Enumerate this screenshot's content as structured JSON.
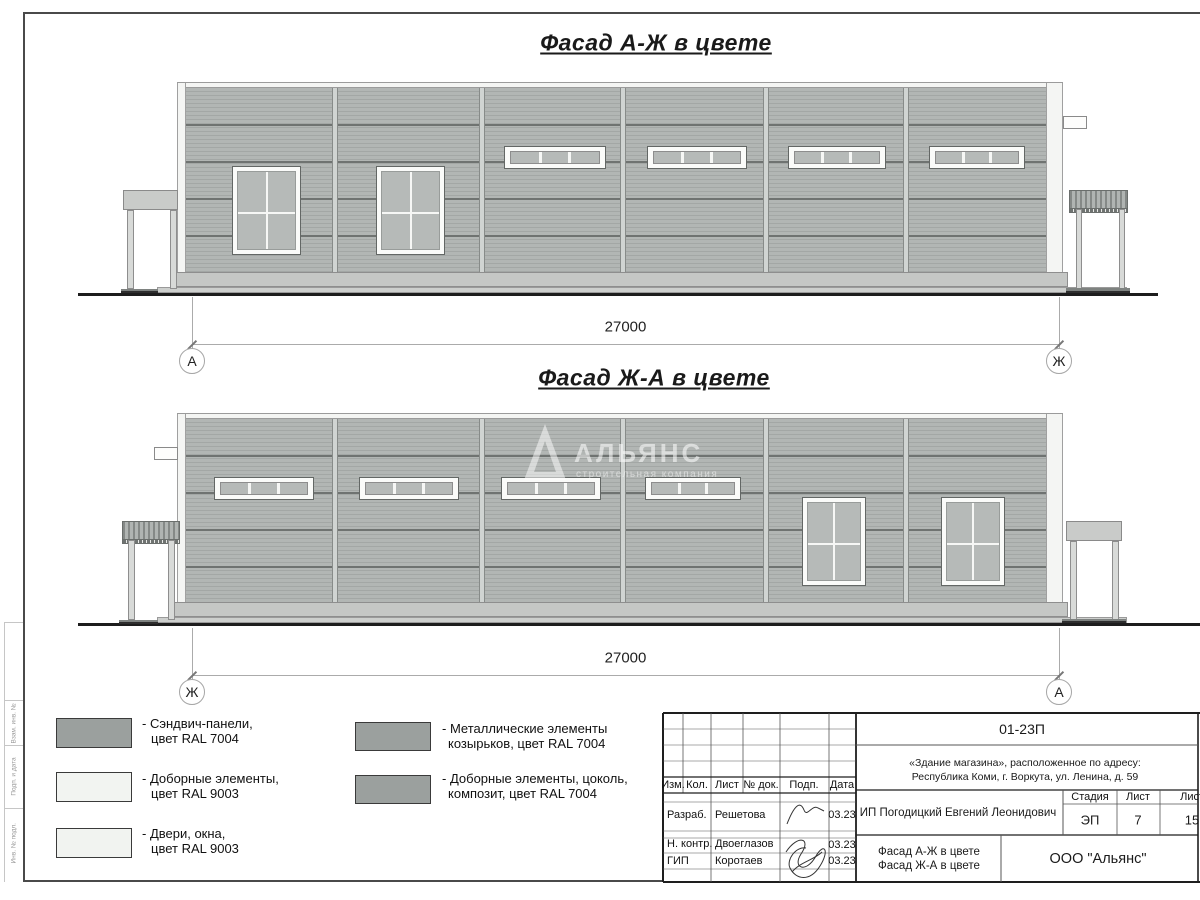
{
  "facades": [
    {
      "title": "Фасад А-Ж в цвете",
      "dim": "27000",
      "axis_left": "А",
      "axis_right": "Ж"
    },
    {
      "title": "Фасад Ж-А в цвете",
      "dim": "27000",
      "axis_left": "Ж",
      "axis_right": "А"
    }
  ],
  "watermark": {
    "name": "АЛЬЯНС",
    "tagline": "строительная компания"
  },
  "legend": {
    "items": [
      {
        "color": "#9ba09e",
        "line1": "- Сэндвич-панели,",
        "line2": "цвет RAL 7004"
      },
      {
        "color": "#f2f4f1",
        "line1": "- Доборные элементы,",
        "line2": "цвет RAL 9003"
      },
      {
        "color": "#f1f3f0",
        "line1": "- Двери, окна,",
        "line2": "цвет RAL 9003"
      },
      {
        "color": "#9ba09e",
        "line1": "- Металлические элементы",
        "line2": "козырьков, цвет RAL 7004"
      },
      {
        "color": "#9ba09e",
        "line1": "- Доборные элементы, цоколь,",
        "line2": "композит, цвет RAL 7004"
      }
    ]
  },
  "title_block": {
    "doc_number": "01-23П",
    "address_line1": "«Здание магазина», расположенное по адресу:",
    "address_line2": "Республика Коми, г. Воркута, ул. Ленина, д. 59",
    "client": "ИП Погодицкий Евгений Леонидович",
    "stage_label": "Стадия",
    "sheet_label": "Лист",
    "sheets_label": "Листов",
    "stage": "ЭП",
    "sheet": "7",
    "sheets": "15",
    "drawing_title_line1": "Фасад А-Ж в цвете",
    "drawing_title_line2": "Фасад Ж-А в цвете",
    "company": "ООО \"Альянс\"",
    "header_cols": [
      "Изм.",
      "Кол.",
      "Лист",
      "№ док.",
      "Подп.",
      "Дата"
    ],
    "rows": [
      {
        "role": "Разраб.",
        "name": "Решетова",
        "date": "03.23"
      },
      {
        "role": "Н. контр.",
        "name": "Двоеглазов",
        "date": "03.23"
      },
      {
        "role": "ГИП",
        "name": "Коротаев",
        "date": "03.23"
      }
    ]
  },
  "margin_labels": [
    "Взам. инв. №",
    "Подп. и дата",
    "Инв. № подл."
  ],
  "colors": {
    "panel": "#b2b6b4",
    "panel_stripe": "#a3a7a5",
    "seam": "#6f7371",
    "joint": "#d0d4d2",
    "trim_white": "#f4f5f3",
    "window_pane": "#b6bab8",
    "plinth": "#c5c7c5",
    "ground": "#1d1d1d",
    "dim": "#ababab"
  }
}
